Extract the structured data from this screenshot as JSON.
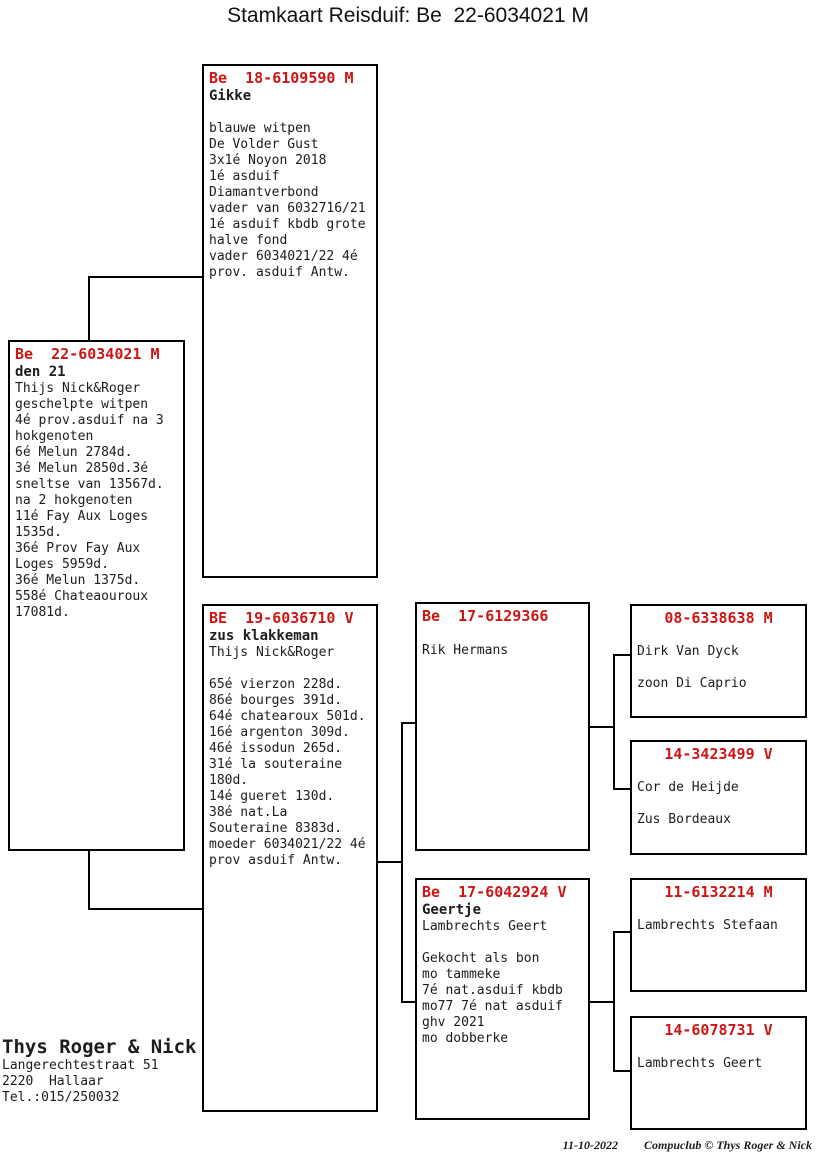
{
  "title": "Stamkaart Reisduif: Be  22-6034021 M",
  "colors": {
    "ring_red": "#cc1616",
    "text": "#1c1c1c",
    "line": "#000000",
    "background": "#ffffff"
  },
  "boxes": {
    "subject": {
      "ring": "Be  22-6034021 M",
      "name": "den 21",
      "lines": [
        "Thijs Nick&Roger",
        "geschelpte witpen",
        "4é prov.asduif na 3",
        "hokgenoten",
        "6é Melun 2784d.",
        "3é Melun 2850d.3é",
        "sneltse van 13567d.",
        "na 2 hokgenoten",
        "11é Fay Aux Loges",
        "1535d.",
        "36é Prov Fay Aux",
        "Loges 5959d.",
        "36é Melun 1375d.",
        "558é Chateaouroux",
        "17081d."
      ]
    },
    "father": {
      "ring": "Be  18-6109590 M",
      "name": "Gikke",
      "lines": [
        "",
        "blauwe witpen",
        "De Volder Gust",
        "3x1é Noyon 2018",
        "1é asduif",
        "Diamantverbond",
        "vader van 6032716/21",
        "1é asduif kbdb grote",
        "halve fond",
        "vader 6034021/22 4é",
        "prov. asduif Antw."
      ]
    },
    "mother": {
      "ring": "BE  19-6036710 V",
      "name": "zus klakkeman",
      "lines": [
        "Thijs Nick&Roger",
        "",
        "65é vierzon 228d.",
        "86é bourges 391d.",
        "64é chatearoux 501d.",
        "16é argenton 309d.",
        "46é issodun 265d.",
        "31é la souteraine",
        "180d.",
        "14é gueret 130d.",
        "38é nat.La",
        "Souteraine 8383d.",
        "moeder 6034021/22 4é",
        "prov asduif Antw."
      ]
    },
    "m_father": {
      "ring": "Be  17-6129366",
      "name": "",
      "lines": [
        "Rik Hermans"
      ]
    },
    "m_mother": {
      "ring": "Be  17-6042924 V",
      "name": "Geertje",
      "lines": [
        "Lambrechts Geert",
        "",
        "Gekocht als bon",
        "mo tammeke",
        "7é nat.asduif kbdb",
        "mo77 7é nat asduif",
        "ghv 2021",
        "mo dobberke"
      ]
    },
    "mf_father": {
      "ring": "08-6338638 M",
      "lines": [
        "",
        "Dirk Van Dyck",
        "",
        "zoon Di Caprio"
      ]
    },
    "mf_mother": {
      "ring": "14-3423499 V",
      "lines": [
        "",
        "Cor de Heijde",
        "",
        "Zus Bordeaux"
      ]
    },
    "mm_father": {
      "ring": "11-6132214 M",
      "lines": [
        "",
        "Lambrechts Stefaan"
      ]
    },
    "mm_mother": {
      "ring": "14-6078731 V",
      "lines": [
        "",
        "Lambrechts Geert"
      ]
    }
  },
  "owner": {
    "name": "Thys Roger & Nick",
    "address1": "Langerechtestraat 51",
    "address2": "2220  Hallaar",
    "phone": "Tel.:015/250032"
  },
  "footer": {
    "date": "11-10-2022",
    "credit": "Compuclub © Thys Roger & Nick"
  }
}
